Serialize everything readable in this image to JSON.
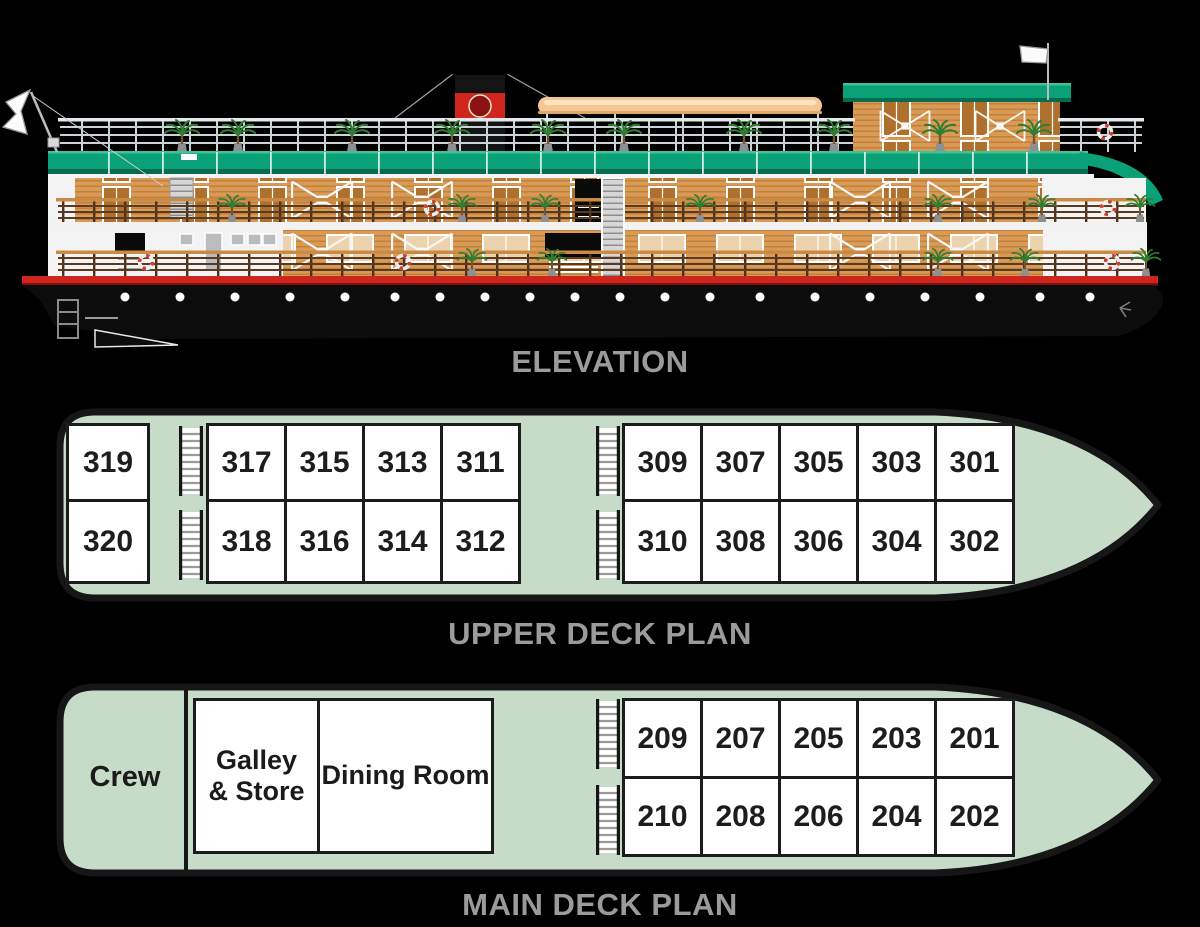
{
  "labels": {
    "elevation": "ELEVATION",
    "upper_deck": "UPPER DECK PLAN",
    "main_deck": "MAIN DECK PLAN"
  },
  "upper_deck": {
    "aft_top": [
      "319"
    ],
    "aft_bottom": [
      "320"
    ],
    "mid_top": [
      "317",
      "315",
      "313",
      "311"
    ],
    "mid_bottom": [
      "318",
      "316",
      "314",
      "312"
    ],
    "fore_top": [
      "309",
      "307",
      "305",
      "303",
      "301"
    ],
    "fore_bottom": [
      "310",
      "308",
      "306",
      "304",
      "302"
    ]
  },
  "main_deck": {
    "crew_label": "Crew",
    "galley_store_label": "Galley & Store",
    "dining_room_label": "Dining Room",
    "fore_top": [
      "209",
      "207",
      "205",
      "203",
      "201"
    ],
    "fore_bottom": [
      "210",
      "208",
      "206",
      "204",
      "202"
    ]
  },
  "colors": {
    "deck_fill": "#c6dcc9",
    "deck_border": "#161616",
    "cabin_fill": "#ffffff",
    "cabin_border": "#1c1c1c",
    "label_gray": "#9b9b9b",
    "roof_green": "#0aa078",
    "hull_black": "#0c0c0c",
    "stripe_red": "#d0251c",
    "wood_tan": "#d99a56",
    "canopy_tan": "#f5c793"
  }
}
